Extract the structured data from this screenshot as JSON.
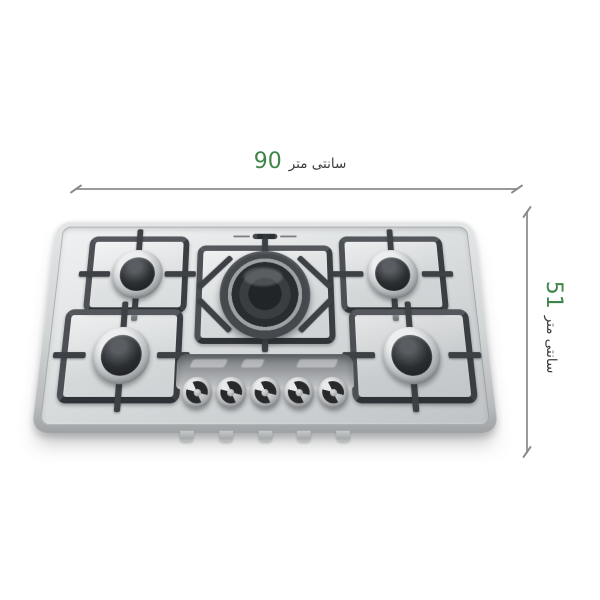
{
  "diagram": {
    "width_dimension": {
      "value": "90",
      "unit": "سانتی متر"
    },
    "height_dimension": {
      "value": "51",
      "unit": "سانتی متر"
    },
    "accent_color": "#3e8549",
    "unit_text_color": "#3c3c3c",
    "dimension_line_color": "#9a9a9a"
  },
  "product": {
    "kind": "five-burner stainless steel gas hob",
    "burner_count": 5,
    "knob_count": 5,
    "colors": {
      "steel_light": "#f0f1f2",
      "steel_dark": "#c0c3c5",
      "grate_frame": "#43474b",
      "burner_cap": "#1f2224"
    }
  }
}
